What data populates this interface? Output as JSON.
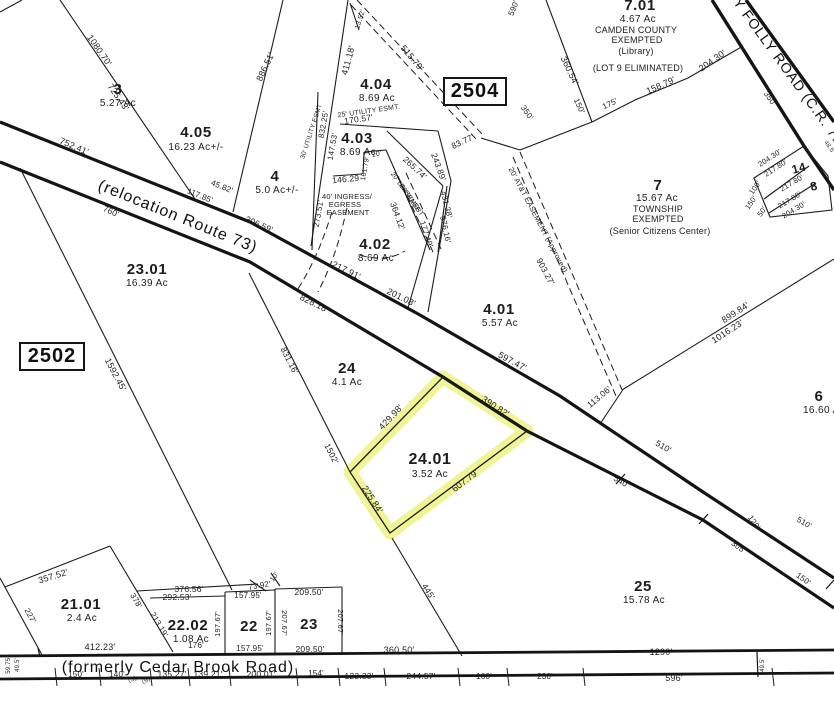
{
  "map_title": "Tax parcel map",
  "blocks": {
    "left": "2502",
    "right": "2504"
  },
  "roads": {
    "route73": "(relocation Route 73)",
    "cedar_brook": "(formerly Cedar Brook Road)",
    "folly": "Y FOLLY ROAD (C.R. 712)"
  },
  "highlight": {
    "lot": "24.01",
    "acreage": "3.52 Ac",
    "color": "#e9ee55"
  },
  "labels": [
    {
      "t": "3",
      "x": 118,
      "y": 94,
      "s": 15,
      "c": "lot",
      "n": "parcel-3-label"
    },
    {
      "t": "5.27 Ac",
      "x": 118,
      "y": 106,
      "s": 10,
      "c": "ac",
      "n": "parcel-3-acreage"
    },
    {
      "t": "4.05",
      "x": 196,
      "y": 137,
      "s": 15,
      "c": "lot",
      "n": "parcel-4.05-label"
    },
    {
      "t": "16.23 Ac+/-",
      "x": 196,
      "y": 150,
      "s": 10,
      "c": "ac",
      "n": "parcel-4.05-acreage"
    },
    {
      "t": "4",
      "x": 275,
      "y": 181,
      "s": 15,
      "c": "lot",
      "n": "parcel-4-label"
    },
    {
      "t": "5.0 Ac+/-",
      "x": 277,
      "y": 193,
      "s": 10,
      "c": "ac",
      "n": "parcel-4-acreage"
    },
    {
      "t": "4.04",
      "x": 376,
      "y": 89,
      "s": 15,
      "c": "lot",
      "n": "parcel-4.04-label"
    },
    {
      "t": "8.69 Ac",
      "x": 377,
      "y": 101,
      "s": 10,
      "c": "ac",
      "n": "parcel-4.04-acreage"
    },
    {
      "t": "4.03",
      "x": 357,
      "y": 143,
      "s": 15,
      "c": "lot",
      "n": "parcel-4.03-label"
    },
    {
      "t": "8.69 Ac",
      "x": 358,
      "y": 155,
      "s": 10,
      "c": "ac",
      "n": "parcel-4.03-acreage"
    },
    {
      "t": "4.02",
      "x": 375,
      "y": 249,
      "s": 15,
      "c": "lot",
      "n": "parcel-4.02-label"
    },
    {
      "t": "8.69 Ac",
      "x": 376,
      "y": 261,
      "s": 10,
      "c": "ac",
      "n": "parcel-4.02-acreage"
    },
    {
      "t": "4.01",
      "x": 499,
      "y": 314,
      "s": 15,
      "c": "lot",
      "n": "parcel-4.01-label"
    },
    {
      "t": "5.57 Ac",
      "x": 500,
      "y": 326,
      "s": 10,
      "c": "ac",
      "n": "parcel-4.01-acreage"
    },
    {
      "t": "7.01",
      "x": 640,
      "y": 10,
      "s": 15,
      "c": "lot",
      "n": "parcel-7.01-label"
    },
    {
      "t": "4.67 Ac",
      "x": 638,
      "y": 22,
      "s": 10,
      "c": "ac",
      "n": "parcel-7.01-acreage"
    },
    {
      "t": "CAMDEN COUNTY",
      "x": 636,
      "y": 33,
      "s": 9,
      "c": "note"
    },
    {
      "t": "EXEMPTED",
      "x": 637,
      "y": 43,
      "s": 9,
      "c": "note"
    },
    {
      "t": "(Library)",
      "x": 636,
      "y": 54,
      "s": 9,
      "c": "note"
    },
    {
      "t": "(LOT 9 ELIMINATED)",
      "x": 638,
      "y": 71,
      "s": 9,
      "c": "note"
    },
    {
      "t": "7",
      "x": 658,
      "y": 190,
      "s": 15,
      "c": "lot",
      "n": "parcel-7-label"
    },
    {
      "t": "15.67 Ac",
      "x": 657,
      "y": 201,
      "s": 10,
      "c": "ac",
      "n": "parcel-7-acreage"
    },
    {
      "t": "TOWNSHIP",
      "x": 658,
      "y": 212,
      "s": 9,
      "c": "note"
    },
    {
      "t": "EXEMPTED",
      "x": 658,
      "y": 222,
      "s": 9,
      "c": "note"
    },
    {
      "t": "(Senior Citizens Center)",
      "x": 660,
      "y": 234,
      "s": 9,
      "c": "note"
    },
    {
      "t": "23.01",
      "x": 147,
      "y": 274,
      "s": 15,
      "c": "lot",
      "n": "parcel-23.01-label"
    },
    {
      "t": "16.39 Ac",
      "x": 147,
      "y": 286,
      "s": 10,
      "c": "ac",
      "n": "parcel-23.01-acreage"
    },
    {
      "t": "24",
      "x": 347,
      "y": 373,
      "s": 15,
      "c": "lot",
      "n": "parcel-24-label"
    },
    {
      "t": "4.1 Ac",
      "x": 347,
      "y": 385,
      "s": 10,
      "c": "ac",
      "n": "parcel-24-acreage"
    },
    {
      "t": "24.01",
      "x": 430,
      "y": 464,
      "s": 16,
      "c": "lot",
      "n": "parcel-24.01-label"
    },
    {
      "t": "3.52 Ac",
      "x": 430,
      "y": 477,
      "s": 10,
      "c": "ac",
      "n": "parcel-24.01-acreage"
    },
    {
      "t": "25",
      "x": 643,
      "y": 591,
      "s": 15,
      "c": "lot",
      "n": "parcel-25-label"
    },
    {
      "t": "15.78 Ac",
      "x": 644,
      "y": 603,
      "s": 10,
      "c": "ac",
      "n": "parcel-25-acreage"
    },
    {
      "t": "6",
      "x": 819,
      "y": 401,
      "s": 15,
      "c": "lot",
      "n": "parcel-6-label"
    },
    {
      "t": "16.60 Ac",
      "x": 824,
      "y": 413,
      "s": 10,
      "c": "ac",
      "n": "parcel-6-acreage"
    },
    {
      "t": "21.01",
      "x": 81,
      "y": 609,
      "s": 15,
      "c": "lot",
      "n": "parcel-21.01-label"
    },
    {
      "t": "2.4 Ac",
      "x": 82,
      "y": 621,
      "s": 10,
      "c": "ac",
      "n": "parcel-21.01-acreage"
    },
    {
      "t": "22.02",
      "x": 188,
      "y": 630,
      "s": 15,
      "c": "lot",
      "n": "parcel-22.02-label"
    },
    {
      "t": "1.08 Ac",
      "x": 191,
      "y": 642,
      "s": 10,
      "c": "ac",
      "n": "parcel-22.02-acreage"
    },
    {
      "t": "22",
      "x": 249,
      "y": 631,
      "s": 15,
      "c": "lot",
      "n": "parcel-22-label"
    },
    {
      "t": "23",
      "x": 309,
      "y": 629,
      "s": 15,
      "c": "lot",
      "n": "parcel-23-label"
    },
    {
      "t": "14",
      "x": 800,
      "y": 172,
      "r": -15,
      "s": 12,
      "c": "lot",
      "n": "parcel-14-label"
    },
    {
      "t": "8",
      "x": 815,
      "y": 190,
      "r": -15,
      "s": 12,
      "c": "lot",
      "n": "parcel-8-label"
    },
    {
      "t": "(relocation Route 73)",
      "x": 176,
      "y": 221,
      "r": 22,
      "s": 16,
      "ls": 1,
      "c": "road",
      "n": "route-73-name"
    },
    {
      "t": "(formerly Cedar Brook Road)",
      "x": 178,
      "y": 672,
      "s": 16,
      "ls": 0.5,
      "c": "road",
      "n": "cedar-brook-road-name"
    },
    {
      "t": "Y FOLLY ROAD (C.R. 712)",
      "x": 789,
      "y": 80,
      "r": 54,
      "s": 14,
      "ls": 0.5,
      "c": "road",
      "n": "folly-road-name"
    },
    {
      "t": "1080.70'",
      "x": 97,
      "y": 52,
      "r": 55
    },
    {
      "t": "725.43'",
      "x": 116,
      "y": 99,
      "r": 55
    },
    {
      "t": "752.41'",
      "x": 73,
      "y": 149,
      "r": 23
    },
    {
      "t": "886.51'",
      "x": 268,
      "y": 68,
      "r": -65
    },
    {
      "t": "411.18'",
      "x": 351,
      "y": 61,
      "r": -75
    },
    {
      "t": "13.52'",
      "x": 362,
      "y": 20,
      "r": -72,
      "s": 7
    },
    {
      "t": "515.79'",
      "x": 410,
      "y": 60,
      "r": 50
    },
    {
      "t": "590'",
      "x": 516,
      "y": 9,
      "r": -68,
      "s": 8
    },
    {
      "t": "360.54'",
      "x": 567,
      "y": 72,
      "r": 65
    },
    {
      "t": "150'",
      "x": 577,
      "y": 107,
      "r": 65,
      "s": 8
    },
    {
      "t": "175'",
      "x": 611,
      "y": 106,
      "r": -25,
      "s": 8
    },
    {
      "t": "158.79'",
      "x": 662,
      "y": 88,
      "r": -24
    },
    {
      "t": "204.30'",
      "x": 714,
      "y": 63,
      "r": -35
    },
    {
      "t": "832.25'",
      "x": 326,
      "y": 125,
      "r": -80,
      "s": 8
    },
    {
      "t": "147.53'",
      "x": 335,
      "y": 147,
      "r": -80,
      "s": 8
    },
    {
      "t": "30' UTILITY ESMT",
      "x": 313,
      "y": 132,
      "r": -72,
      "s": 6.5
    },
    {
      "t": "25' UTILITY ESMT.",
      "x": 369,
      "y": 113,
      "r": -8,
      "s": 7
    },
    {
      "t": "170.57'",
      "x": 359,
      "y": 122,
      "r": -8,
      "s": 8.5
    },
    {
      "t": "146.29",
      "x": 346,
      "y": 182,
      "r": -6,
      "s": 8.5
    },
    {
      "t": "161.79'",
      "x": 367,
      "y": 169,
      "r": -80,
      "s": 7
    },
    {
      "t": "20'",
      "x": 377,
      "y": 156,
      "r": -10,
      "s": 7
    },
    {
      "t": "265.74'",
      "x": 413,
      "y": 170,
      "r": 43,
      "s": 8.5
    },
    {
      "t": "243.89'",
      "x": 436,
      "y": 168,
      "r": 70,
      "s": 8.5
    },
    {
      "t": "431.38'",
      "x": 444,
      "y": 205,
      "r": 76,
      "s": 8
    },
    {
      "t": "177.49'",
      "x": 424,
      "y": 235,
      "r": 72,
      "s": 8
    },
    {
      "t": "576.16'",
      "x": 443,
      "y": 230,
      "r": 78,
      "s": 8
    },
    {
      "t": "364.12'",
      "x": 395,
      "y": 217,
      "r": 70,
      "s": 8.5
    },
    {
      "t": "20' DRAINAGE",
      "x": 404,
      "y": 193,
      "r": 55,
      "s": 6.5
    },
    {
      "t": "EASEMENT",
      "x": 410,
      "y": 201,
      "r": 55,
      "s": 6.5
    },
    {
      "t": "40' INGRESS/",
      "x": 347,
      "y": 199,
      "s": 7.5
    },
    {
      "t": "EGRESS",
      "x": 345,
      "y": 207,
      "s": 7.5
    },
    {
      "t": "EASEMENT",
      "x": 348,
      "y": 215,
      "s": 7.5
    },
    {
      "t": "273.51'",
      "x": 321,
      "y": 214,
      "r": -80,
      "s": 8
    },
    {
      "t": "83.77'",
      "x": 464,
      "y": 144,
      "r": -25,
      "s": 8.5
    },
    {
      "t": "20' AT&T EASEMENT (Approved)",
      "x": 536,
      "y": 221,
      "r": 62,
      "s": 7.5
    },
    {
      "t": "903.27'",
      "x": 543,
      "y": 273,
      "r": 62,
      "s": 8.5
    },
    {
      "t": "350'",
      "x": 525,
      "y": 114,
      "r": 55,
      "s": 8
    },
    {
      "t": "350'",
      "x": 768,
      "y": 100,
      "r": 55,
      "s": 8
    },
    {
      "t": "597.47'",
      "x": 511,
      "y": 364,
      "r": 28
    },
    {
      "t": "306.59'",
      "x": 258,
      "y": 227,
      "r": 24,
      "s": 8.5
    },
    {
      "t": "760'",
      "x": 110,
      "y": 214,
      "r": 24,
      "s": 8.5
    },
    {
      "t": "117.85'",
      "x": 199,
      "y": 198,
      "r": 22,
      "s": 8
    },
    {
      "t": "45.82'",
      "x": 221,
      "y": 189,
      "r": 22,
      "s": 8
    },
    {
      "t": "217.91'",
      "x": 345,
      "y": 273,
      "r": 26
    },
    {
      "t": "201.08'",
      "x": 400,
      "y": 300,
      "r": 26
    },
    {
      "t": "828.18'",
      "x": 313,
      "y": 306,
      "r": 26
    },
    {
      "t": "1592.45'",
      "x": 113,
      "y": 376,
      "r": 62
    },
    {
      "t": "831.16'",
      "x": 287,
      "y": 362,
      "r": 63,
      "s": 8.5
    },
    {
      "t": "1502'",
      "x": 329,
      "y": 455,
      "r": 63,
      "s": 8.5
    },
    {
      "t": "429.98'",
      "x": 393,
      "y": 419,
      "r": -47
    },
    {
      "t": "390.82'",
      "x": 494,
      "y": 409,
      "r": 33
    },
    {
      "t": "607.79'",
      "x": 467,
      "y": 483,
      "r": -37
    },
    {
      "t": "225.84'",
      "x": 370,
      "y": 501,
      "r": 57
    },
    {
      "t": "899.84'",
      "x": 737,
      "y": 315,
      "r": -33
    },
    {
      "t": "1016.23'",
      "x": 729,
      "y": 334,
      "r": -33
    },
    {
      "t": "113.06'",
      "x": 601,
      "y": 399,
      "r": -40,
      "s": 8.5
    },
    {
      "t": "510'",
      "x": 662,
      "y": 449,
      "r": 30,
      "s": 8.5
    },
    {
      "t": "540'",
      "x": 620,
      "y": 484,
      "r": 30,
      "s": 8.5
    },
    {
      "t": "120'",
      "x": 752,
      "y": 524,
      "r": 55,
      "s": 8
    },
    {
      "t": "305'",
      "x": 737,
      "y": 549,
      "r": 35,
      "s": 8
    },
    {
      "t": "510'",
      "x": 803,
      "y": 525,
      "r": 30,
      "s": 8
    },
    {
      "t": "150'",
      "x": 802,
      "y": 581,
      "r": 35,
      "s": 8
    },
    {
      "t": "48.5'",
      "x": 828,
      "y": 148,
      "r": 54,
      "s": 6
    },
    {
      "t": "204.30'",
      "x": 771,
      "y": 160,
      "r": -33,
      "s": 7.5
    },
    {
      "t": "217.80'",
      "x": 777,
      "y": 170,
      "r": -33,
      "s": 7.5
    },
    {
      "t": "217.80'",
      "x": 793,
      "y": 185,
      "r": -31,
      "s": 7.5
    },
    {
      "t": "217.80'",
      "x": 791,
      "y": 202,
      "r": -31,
      "s": 7.5
    },
    {
      "t": "204.30'",
      "x": 795,
      "y": 212,
      "r": -31,
      "s": 7.5
    },
    {
      "t": "100'",
      "x": 757,
      "y": 189,
      "r": -55,
      "s": 7.5
    },
    {
      "t": "150'",
      "x": 753,
      "y": 204,
      "r": -55,
      "s": 7.5
    },
    {
      "t": "50'",
      "x": 764,
      "y": 213,
      "r": -55,
      "s": 7.5
    },
    {
      "t": "445'",
      "x": 426,
      "y": 593,
      "r": 58,
      "s": 8.5
    },
    {
      "t": "360.50'",
      "x": 399,
      "y": 653
    },
    {
      "t": "1290'",
      "x": 661,
      "y": 655
    },
    {
      "t": "596'",
      "x": 674,
      "y": 681
    },
    {
      "t": "49.5'",
      "x": 764,
      "y": 665,
      "r": -90,
      "s": 6
    },
    {
      "t": "412.23'",
      "x": 100,
      "y": 650
    },
    {
      "t": "357.52'",
      "x": 54,
      "y": 579,
      "r": -17
    },
    {
      "t": "227'",
      "x": 28,
      "y": 617,
      "r": 61,
      "s": 8
    },
    {
      "t": "378'",
      "x": 134,
      "y": 602,
      "r": 59,
      "s": 8
    },
    {
      "t": "213.19'",
      "x": 157,
      "y": 626,
      "r": 59,
      "s": 8
    },
    {
      "t": "376.56'",
      "x": 189,
      "y": 592,
      "s": 8.5
    },
    {
      "t": "292.53'",
      "x": 177,
      "y": 600,
      "s": 8.5
    },
    {
      "t": "73.92'",
      "x": 260,
      "y": 588,
      "r": -10,
      "s": 8
    },
    {
      "t": "10'",
      "x": 276,
      "y": 578,
      "r": -55,
      "s": 7
    },
    {
      "t": "157.95'",
      "x": 248,
      "y": 598,
      "s": 8
    },
    {
      "t": "209.50'",
      "x": 309,
      "y": 595,
      "s": 8.5
    },
    {
      "t": "197.67'",
      "x": 220,
      "y": 624,
      "r": -90,
      "s": 7.5
    },
    {
      "t": "197.67'",
      "x": 271,
      "y": 623,
      "r": -90,
      "s": 7.5
    },
    {
      "t": "207.67'",
      "x": 282,
      "y": 623,
      "r": 90,
      "s": 7.5
    },
    {
      "t": "207.67'",
      "x": 338,
      "y": 622,
      "r": 90,
      "s": 7.5
    },
    {
      "t": "176'",
      "x": 196,
      "y": 648,
      "s": 8
    },
    {
      "t": "157.95'",
      "x": 250,
      "y": 651,
      "s": 8
    },
    {
      "t": "209.50'",
      "x": 310,
      "y": 652,
      "s": 8.5
    },
    {
      "t": "150'",
      "x": 76,
      "y": 677,
      "s": 8
    },
    {
      "t": "140'",
      "x": 117,
      "y": 677,
      "s": 8
    },
    {
      "t": "(S)",
      "x": 133,
      "y": 681,
      "r": -20,
      "s": 6
    },
    {
      "t": "(S)",
      "x": 147,
      "y": 682,
      "r": -30,
      "s": 6
    },
    {
      "t": "135.27'",
      "x": 172,
      "y": 677,
      "s": 8.5
    },
    {
      "t": "139.21'",
      "x": 208,
      "y": 677,
      "s": 8.5
    },
    {
      "t": "200.01'",
      "x": 261,
      "y": 677,
      "s": 8.5
    },
    {
      "t": "154'",
      "x": 316,
      "y": 676,
      "s": 8
    },
    {
      "t": "123.33'",
      "x": 359,
      "y": 679,
      "s": 8.5
    },
    {
      "t": "244.57'",
      "x": 421,
      "y": 679,
      "s": 8.5
    },
    {
      "t": "160'",
      "x": 484,
      "y": 679,
      "s": 8
    },
    {
      "t": "230'",
      "x": 545,
      "y": 679,
      "s": 8
    },
    {
      "t": "59.75'",
      "x": 10,
      "y": 665,
      "r": -90,
      "s": 6
    },
    {
      "t": "49.5'",
      "x": 19,
      "y": 665,
      "r": -90,
      "s": 6
    }
  ]
}
